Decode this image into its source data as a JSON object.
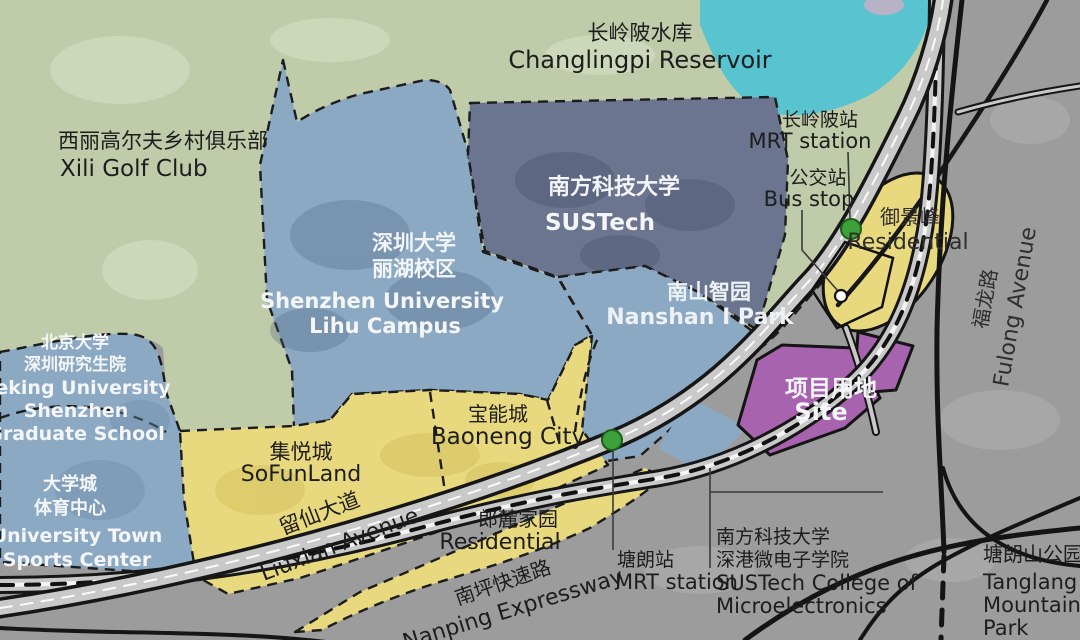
{
  "map": {
    "colors": {
      "terrain_gray": "#9c9c9c",
      "green_area": "#c0cba9",
      "water": "#58c4cf",
      "campus_blue": "#8ba9c3",
      "sustech_slate": "#6b7590",
      "commercial_yellow": "#e9d97e",
      "site_purple": "#a763ae",
      "road_fill": "#c9c9c9",
      "road_edge": "#161616",
      "station_green": "#3ca138"
    },
    "labels": {
      "reservoir_zh": "长岭陂水库",
      "reservoir_en": "Changlingpi Reservoir",
      "golf_zh": "西丽高尔夫乡村俱乐部",
      "golf_en": "Xili Golf Club",
      "szu_zh1": "深圳大学",
      "szu_zh2": "丽湖校区",
      "szu_en1": "Shenzhen University",
      "szu_en2": "Lihu Campus",
      "sustech_zh": "南方科技大学",
      "sustech_en": "SUSTech",
      "nanshan_zh": "南山智园",
      "nanshan_en": "Nanshan I Park",
      "pku_zh1": "北京大学",
      "pku_zh2": "深圳研究生院",
      "pku_en1": "Peking University",
      "pku_en2": "Shenzhen",
      "pku_en3": "Graduate School",
      "sports_zh1": "大学城",
      "sports_zh2": "体育中心",
      "sports_en1": "University Town",
      "sports_en2": "Sports Center",
      "sofun_zh": "集悦城",
      "sofun_en": "SoFunLand",
      "baoneng_zh": "宝能城",
      "baoneng_en": "Baoneng City",
      "langlu_zh": "郎麓家园",
      "langlu_en": "Residential",
      "yujing_zh": "御景峰",
      "yujing_en": "Residential",
      "site_zh": "项目用地",
      "site_en": "Site",
      "tanglangpark_zh": "塘朗山公园",
      "tanglangpark_en1": "Tanglang",
      "tanglangpark_en2": "Mountain",
      "tanglangpark_en3": "Park",
      "liuxian_zh": "留仙大道",
      "liuxian_en": "Liuxian Avenue",
      "nanping_zh": "南坪快速路",
      "nanping_en": "Nanping Expressway",
      "fulong_zh": "福龙路",
      "fulong_en": "Fulong Avenue",
      "clp_station_zh": "长岭陂站",
      "clp_station_en": "MRT station",
      "bus_zh": "公交站",
      "bus_en": "Bus stop",
      "tl_station_zh": "塘朗站",
      "tl_station_en": "MRT station",
      "micro_zh1": "南方科技大学",
      "micro_zh2": "深港微电子学院",
      "micro_en1": "SUSTech College of",
      "micro_en2": "Microelectronics"
    }
  }
}
